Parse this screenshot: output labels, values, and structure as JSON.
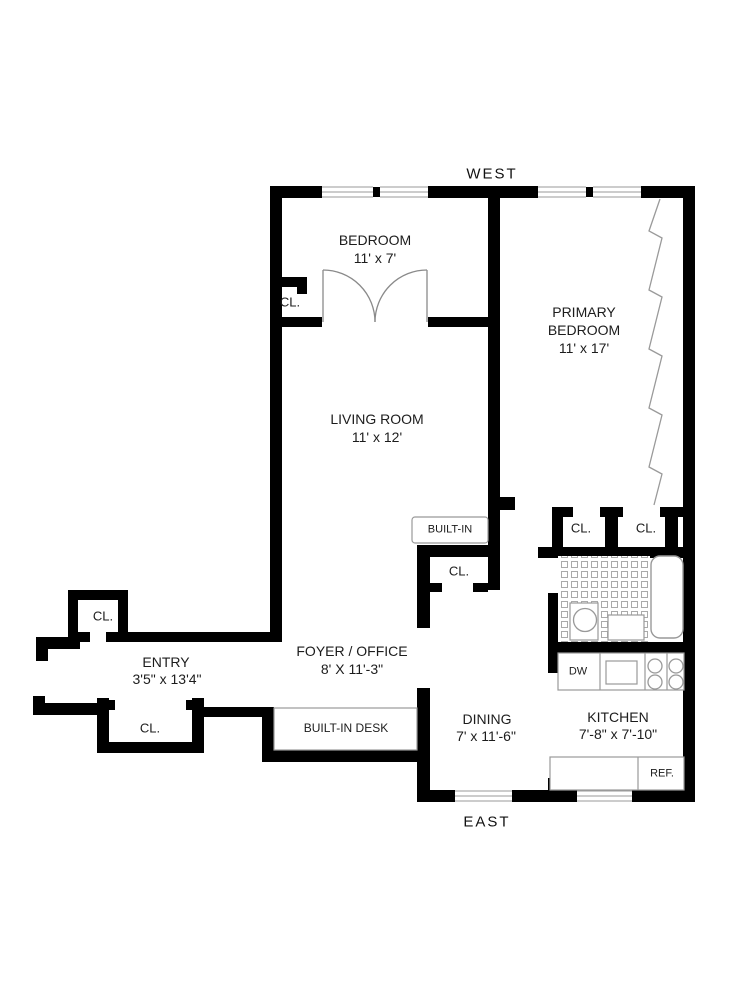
{
  "plan": {
    "title": "apartment-floor-plan",
    "compass": {
      "west": "WEST",
      "east": "EAST"
    },
    "rooms": {
      "bedroom": {
        "name": "BEDROOM",
        "dims": "11' x 7'"
      },
      "primary": {
        "line1": "PRIMARY",
        "line2": "BEDROOM",
        "dims": "11' x 17'"
      },
      "living": {
        "name": "LIVING ROOM",
        "dims": "11' x 12'"
      },
      "foyer": {
        "name": "FOYER / OFFICE",
        "dims": "8' X 11'-3\""
      },
      "entry": {
        "name": "ENTRY",
        "dims": "3'5\" x 13'4\""
      },
      "dining": {
        "name": "DINING",
        "dims": "7' x 11'-6\""
      },
      "kitchen": {
        "name": "KITCHEN",
        "dims": "7'-8\" x 7'-10\""
      }
    },
    "closets": {
      "bedroom_closet": "CL.",
      "entry_upper": "CL.",
      "entry_lower": "CL.",
      "foyer_closet": "CL.",
      "primary_left": "CL.",
      "primary_right": "CL."
    },
    "features": {
      "built_in": "BUILT-IN",
      "built_in_desk": "BUILT-IN DESK",
      "dishwasher": "DW",
      "refrigerator": "REF."
    },
    "colors": {
      "wall": "#000000",
      "fixture_line": "#999999",
      "text": "#1c1c1c"
    }
  }
}
